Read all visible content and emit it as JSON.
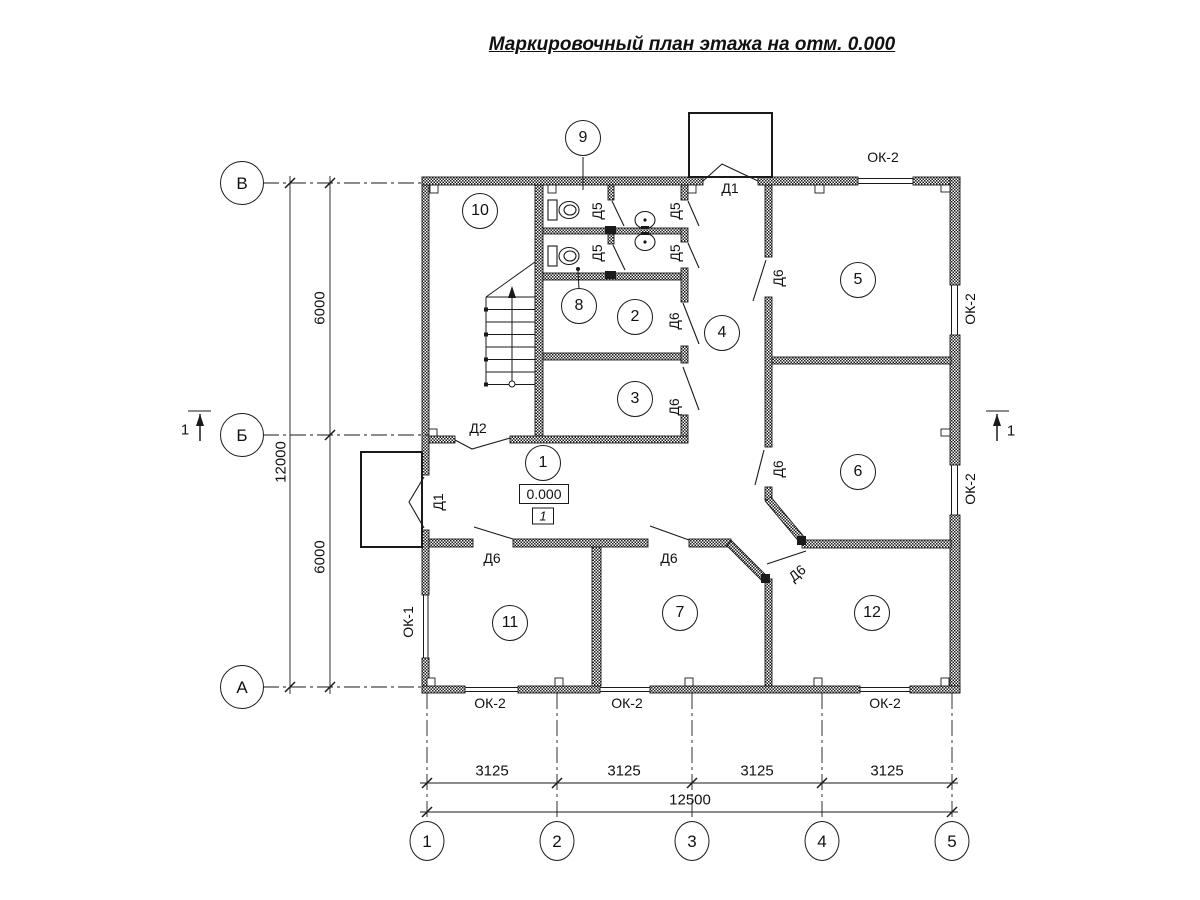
{
  "title": "Маркировочный план этажа на отм. 0.000",
  "axes": {
    "rows": [
      "В",
      "Б",
      "А"
    ],
    "cols": [
      "1",
      "2",
      "3",
      "4",
      "5"
    ]
  },
  "dimensions": {
    "row_total": "12000",
    "row_segments": [
      "6000",
      "6000"
    ],
    "col_segments": [
      "3125",
      "3125",
      "3125",
      "3125"
    ],
    "col_total": "12500"
  },
  "rooms": [
    "1",
    "2",
    "3",
    "4",
    "5",
    "6",
    "7",
    "8",
    "9",
    "10",
    "11",
    "12"
  ],
  "doors": {
    "d1": "Д1",
    "d2": "Д2",
    "d5": "Д5",
    "d6": "Д6"
  },
  "windows": {
    "ok1": "ОК-1",
    "ok2": "ОК-2"
  },
  "elevation": {
    "value": "0.000",
    "floor": "1"
  },
  "section_mark": "1"
}
